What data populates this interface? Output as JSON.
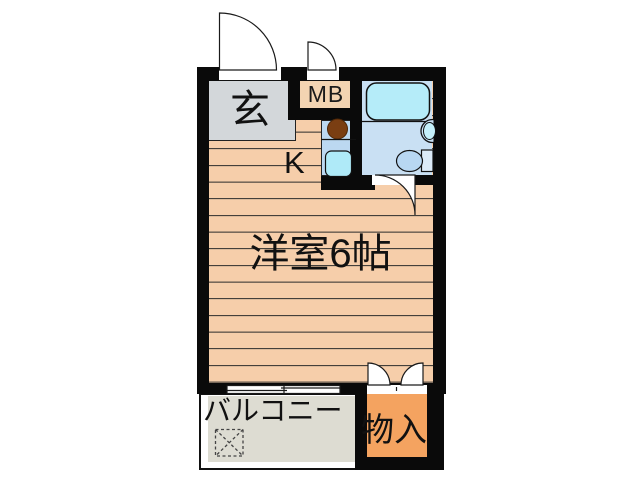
{
  "plan": {
    "type": "apartment-floor-plan",
    "rooms": {
      "genkan": {
        "label": "玄"
      },
      "meter_box": {
        "label": "MB"
      },
      "kitchen": {
        "label": "K"
      },
      "main_room": {
        "label": "洋室6帖"
      },
      "balcony": {
        "label": "バルコニー"
      },
      "storage": {
        "label": "物入"
      }
    },
    "fixtures": [
      "entrance-door-arc",
      "mb-door-arc",
      "bathroom-door-arc",
      "storage-double-door-arcs",
      "sliding-window-symbol",
      "bathtub",
      "wash-basin",
      "toilet",
      "stove-burner",
      "kitchen-sink",
      "washing-machine-pan"
    ],
    "colors": {
      "wall": "#0a0a0a",
      "flooring": "#F6CEAA",
      "flooring_line": "#2b2b2b",
      "genkan": "#D3D7DA",
      "meter_box": "#F3D4B2",
      "kitchen_counter": "#BCD8F1",
      "bathroom": "#C9E0F3",
      "bathtub": "#B5ECF9",
      "kitchen_sink": "#AFEAF8",
      "toilet": "#B8D7F2",
      "storage": "#F4A360",
      "balcony": "#DDDCD2",
      "stove": "#7A3E12",
      "background": "#ffffff"
    }
  }
}
